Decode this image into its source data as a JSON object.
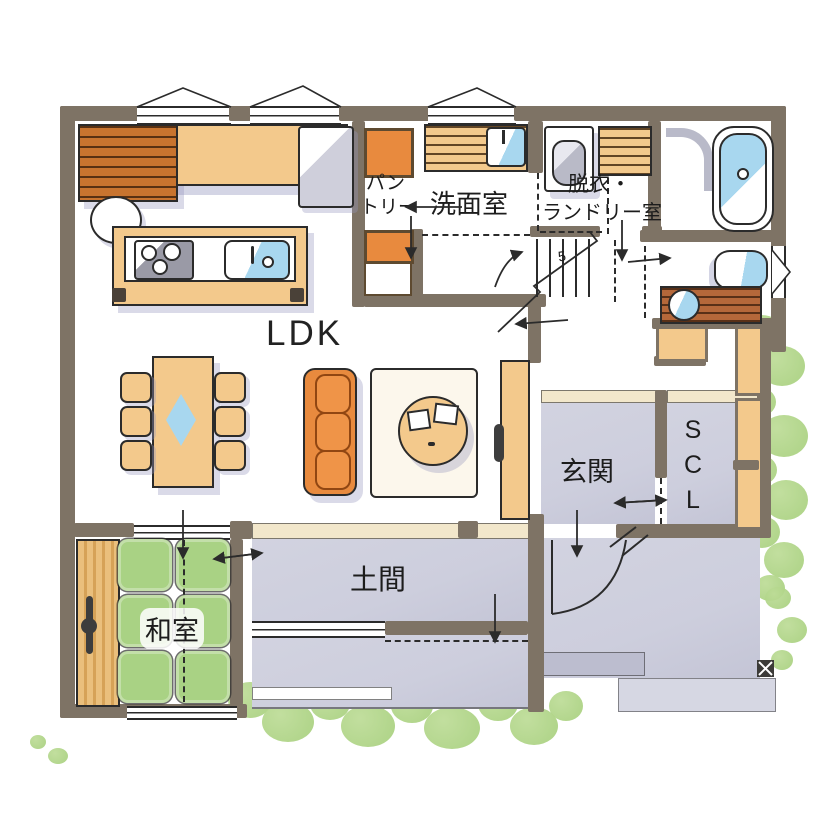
{
  "type": "floor-plan",
  "rooms": {
    "ldk": {
      "label": "LDK"
    },
    "pantry": {
      "label_line1": "パン",
      "label_line2": "トリー"
    },
    "washroom": {
      "label": "洗面室"
    },
    "laundry_room": {
      "label_line1": "脱衣・",
      "label_line2": "ランドリー室"
    },
    "entrance": {
      "label": "玄関"
    },
    "shoe_closet": {
      "label": "SCL"
    },
    "japanese_room": {
      "label": "和室"
    },
    "doma": {
      "label": "土間"
    }
  },
  "annotations": {
    "stairs_mark": "5"
  },
  "colors": {
    "wall": "#7e7365",
    "ink": "#2b2b2b",
    "wood": "#f3c98c",
    "wood-grain": "#c8742f",
    "accent": "#e88a3e",
    "tatami": "#a9d284",
    "floor": "#cdcedd",
    "water": "#a8d7ef",
    "bush": "#a6cf7c",
    "step": "#f2e7cb",
    "shadow": "#b4b6cf"
  }
}
